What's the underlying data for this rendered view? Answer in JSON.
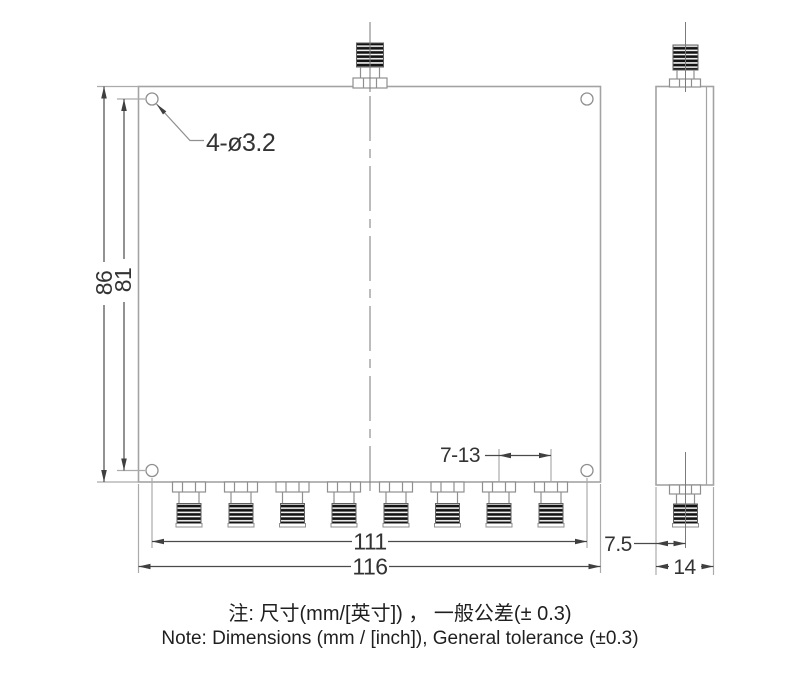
{
  "drawing": {
    "dim_hole_callout": "4-ø3.2",
    "dim_height_overall": "86",
    "dim_height_hole_span": "81",
    "dim_port_pitch": "7-13",
    "dim_width_hole_span": "111",
    "dim_width_overall": "116",
    "dim_side_port_offset": "7.5",
    "dim_side_thickness": "14",
    "front_bottom_connector_count": 8,
    "front_top_connector_count": 1,
    "mounting_hole_count": 4
  },
  "note": {
    "zh": "注: 尺寸(mm/[英寸]) ， 一般公差(±  0.3)",
    "en": "Note: Dimensions (mm / [inch]), General tolerance (±0.3)"
  },
  "colors": {
    "outline": "#a3a3a3",
    "dimension_line": "#4a4a4a",
    "extension_line": "#ababab",
    "centerline": "#7a7a7a",
    "text": "#333333",
    "threads": "#141414",
    "background": "#ffffff"
  }
}
